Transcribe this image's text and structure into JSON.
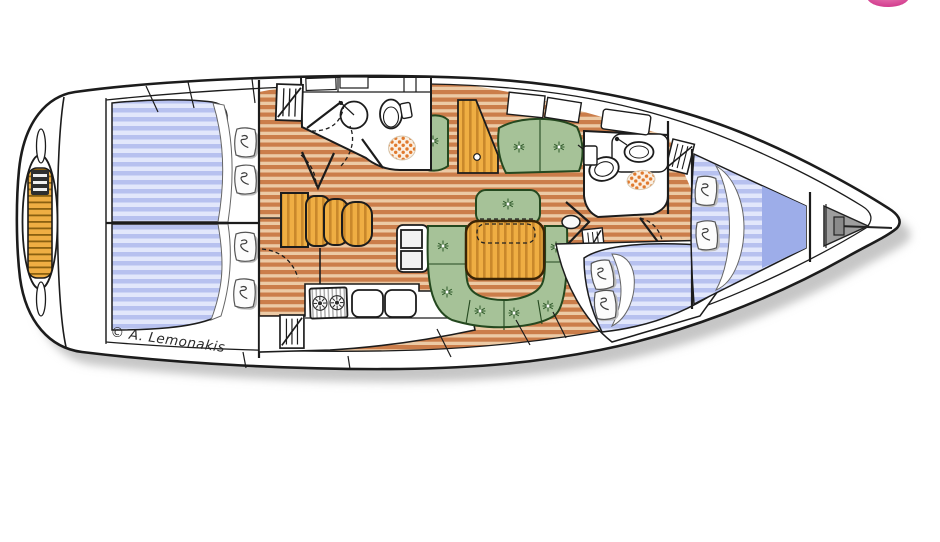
{
  "diagram": {
    "type": "yacht-interior-floor-plan",
    "orientation": "bow to the right, stern (swim platform) to the left",
    "copyright": "© A. Lemonakis",
    "features": [
      "swim platform with teak and ladder",
      "aft double cabin (top) with two pillows",
      "aft double cabin (bottom) with two pillows",
      "hanging lockers (4)",
      "aft head with round sink, toilet, shower mat",
      "chart table with stacked seats",
      "galley: two-burner stove, double sink, icebox",
      "saloon: straight settee, bench seat, U-shaped dinette, folding wood table, wood cabinet",
      "mast post",
      "forward head with sink, toilet, shower mat",
      "forward double berth cabin with two pillows",
      "bow V-berth with two pillows",
      "anchor locker with anchor"
    ]
  },
  "logo": {
    "description": "partial pink circle at top-right edge"
  },
  "colors": {
    "line": "#1c1c1c",
    "hull-fill": "#ffffff",
    "shadow": "#c6c6c6",
    "berth-a": "#b7c1ef",
    "berth-b": "#e2e7fb",
    "berth-deep": "#9dade9",
    "floor-a": "#cb7d4a",
    "floor-b": "#eccaa5",
    "wood-a": "#efae43",
    "wood-b": "#c9882b",
    "teak-dark": "#8a6010",
    "green-fill": "#a6c298",
    "green-line": "#24481f",
    "star": "#2f5a2a",
    "dots": "#e07a2e",
    "dots-bg": "#fbf0e3",
    "anchor-gray": "#9e9e9e",
    "pink": "#d23c8e",
    "pink-light": "#ef8cbd",
    "text": "#2b2b2b",
    "pillow-shadow": "#bdbdbd"
  }
}
